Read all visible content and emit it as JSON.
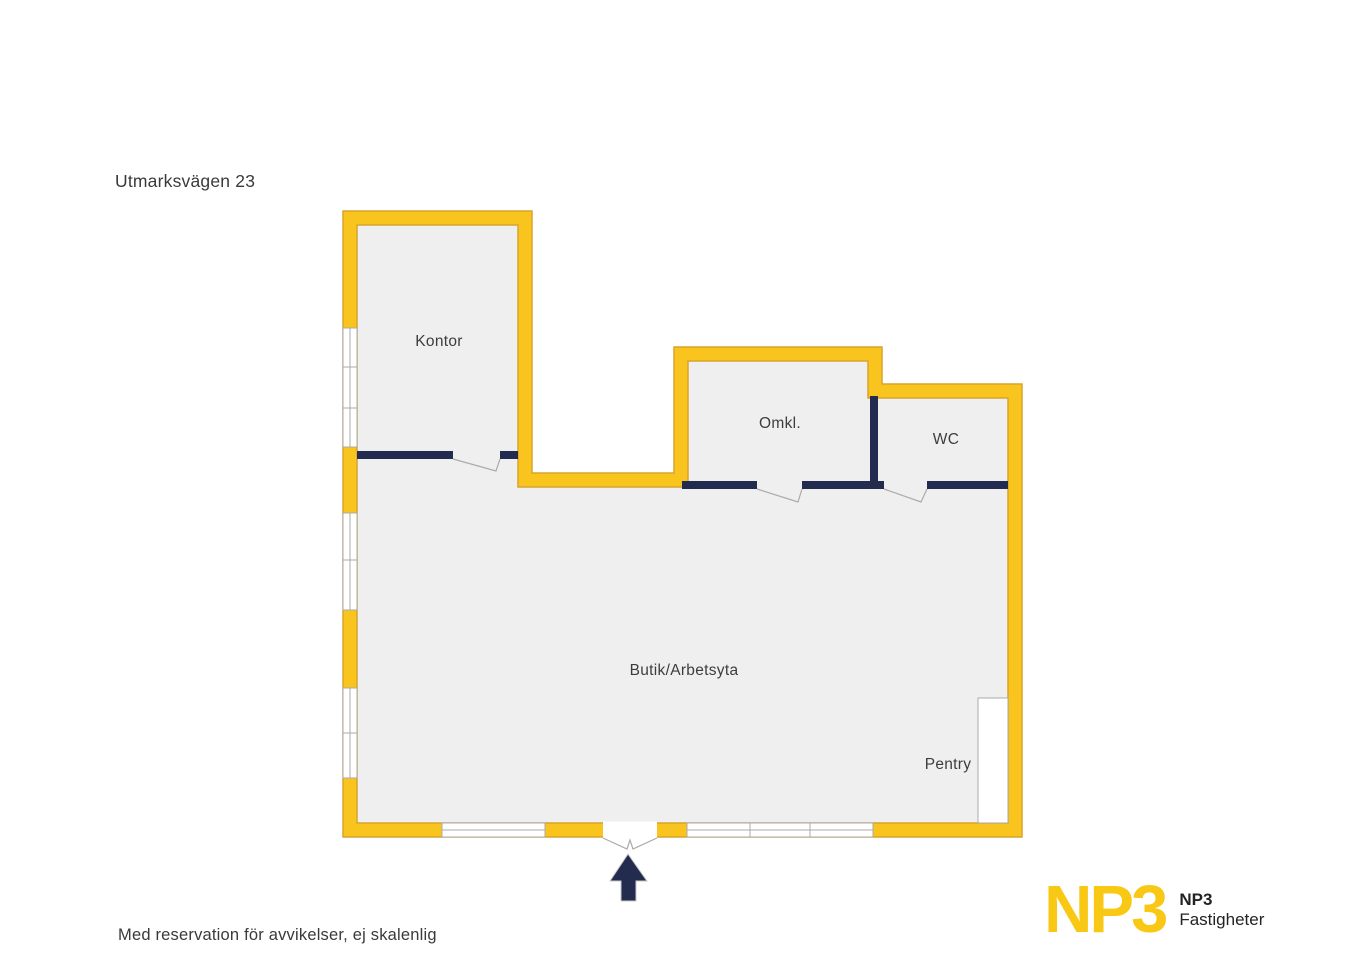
{
  "page": {
    "title": "Utmarksvägen 23",
    "disclaimer": "Med reservation för avvikelser, ej skalenlig"
  },
  "rooms": {
    "kontor": {
      "label": "Kontor"
    },
    "omkl": {
      "label": "Omkl."
    },
    "wc": {
      "label": "WC"
    },
    "butik": {
      "label": "Butik/Arbetsyta"
    },
    "pentry": {
      "label": "Pentry"
    }
  },
  "entrance": {
    "arrow_icon": "up-arrow"
  },
  "logo": {
    "wordmark": "NP3",
    "name": "NP3",
    "subtitle": "Fastigheter"
  },
  "colors": {
    "wall_yellow": "#F9C41E",
    "wall_outline": "#D9A32B",
    "interior_wall_navy": "#232C4E",
    "floor_gray": "#EFEFEF",
    "detail_line_gray": "#ABABAB",
    "text_dark": "#3B3B3B",
    "logo_yellow": "#F9C814",
    "background": "#FFFFFF"
  }
}
